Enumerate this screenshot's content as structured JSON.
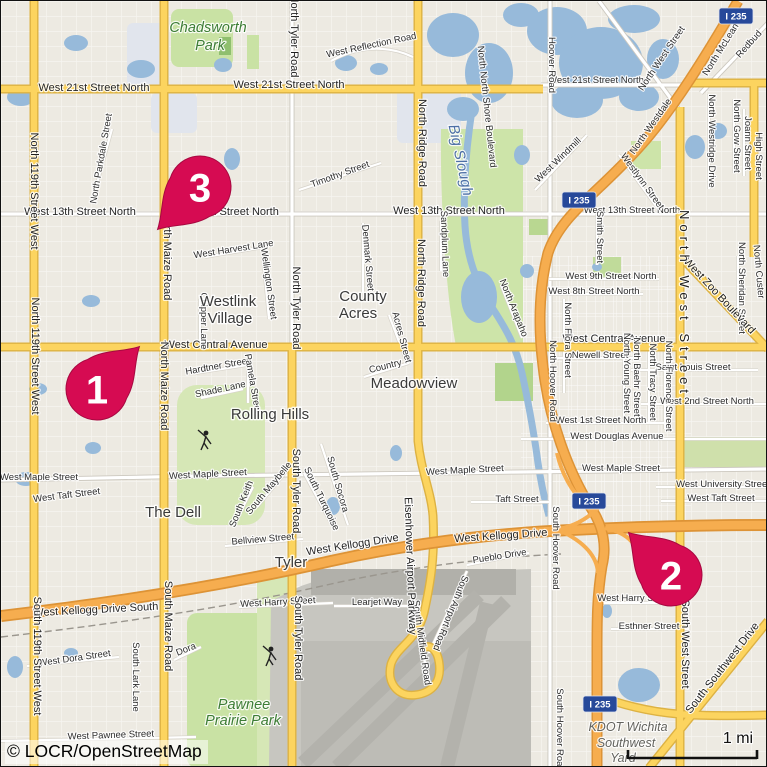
{
  "map": {
    "attribution": "© LOCR/OpenStreetMap",
    "scale_label": "1 mi",
    "colors": {
      "marker": "#d60b52",
      "marker_edge": "#a70840",
      "road_yellow": "#fcd45f",
      "road_yellow_casing": "#ddb243",
      "road_orange": "#f6ad4f",
      "road_orange_casing": "#dd9336",
      "road_white": "#ffffff",
      "road_white_casing": "#ccc8bf",
      "water": "#97bada",
      "park": "#c9e2a4",
      "golf": "#d6e7b6",
      "airport": "#c7c6c0",
      "shield_blue": "#27499a"
    },
    "markers": [
      {
        "label": "1",
        "x": 96,
        "y": 388,
        "rot": 45
      },
      {
        "label": "2",
        "x": 670,
        "y": 574,
        "rot": -45
      },
      {
        "label": "3",
        "x": 199,
        "y": 186,
        "rot": -135
      }
    ],
    "shields": [
      {
        "label": "I 235",
        "x": 735,
        "y": 15
      },
      {
        "label": "I 235",
        "x": 578,
        "y": 199
      },
      {
        "label": "I 235",
        "x": 588,
        "y": 500
      },
      {
        "label": "I 235",
        "x": 599,
        "y": 703
      }
    ],
    "labels": [
      {
        "t": "West 21st Street North",
        "x": 93,
        "y": 90,
        "c": "stl"
      },
      {
        "t": "West 21st Street North",
        "x": 288,
        "y": 87,
        "c": "stl"
      },
      {
        "t": "West 21st Street North",
        "x": 595,
        "y": 82,
        "c": "st"
      },
      {
        "t": "West 13th Street North",
        "x": 79,
        "y": 214,
        "c": "stl"
      },
      {
        "t": "West 13th Street North",
        "x": 222,
        "y": 214,
        "c": "stl"
      },
      {
        "t": "West 13th Street North",
        "x": 448,
        "y": 213,
        "c": "stl"
      },
      {
        "t": "West 13th Street North",
        "x": 631,
        "y": 212,
        "c": "st"
      },
      {
        "t": "West Central Avenue",
        "x": 215,
        "y": 347,
        "c": "stl"
      },
      {
        "t": "West Central Avenue",
        "x": 613,
        "y": 341,
        "c": "stl"
      },
      {
        "t": "West Kellogg Drive",
        "x": 352,
        "y": 547,
        "r": -9,
        "c": "stl"
      },
      {
        "t": "West Kellogg Drive",
        "x": 500,
        "y": 538,
        "r": -4,
        "c": "stl"
      },
      {
        "t": "West Kellogg Drive South",
        "x": 95,
        "y": 612,
        "r": -3,
        "c": "stl"
      },
      {
        "t": "West Reflection Road",
        "x": 371,
        "y": 47,
        "r": -12,
        "c": "st"
      },
      {
        "t": "Timothy Street",
        "x": 340,
        "y": 176,
        "r": -20,
        "c": "st"
      },
      {
        "t": "West Harvest Lane",
        "x": 233,
        "y": 251,
        "r": -9,
        "c": "st"
      },
      {
        "t": "West 9th Street North",
        "x": 610,
        "y": 278,
        "c": "st"
      },
      {
        "t": "West 8th Street North",
        "x": 593,
        "y": 293,
        "c": "st"
      },
      {
        "t": "Newell Street",
        "x": 599,
        "y": 357,
        "c": "st"
      },
      {
        "t": "Saint Louis Street",
        "x": 692,
        "y": 369,
        "c": "st"
      },
      {
        "t": "West 2nd Street North",
        "x": 706,
        "y": 403,
        "c": "st"
      },
      {
        "t": "West 1st Street North",
        "x": 600,
        "y": 422,
        "c": "st"
      },
      {
        "t": "West Douglas Avenue",
        "x": 616,
        "y": 438,
        "c": "st"
      },
      {
        "t": "West Maple Street",
        "x": 38,
        "y": 479,
        "c": "st"
      },
      {
        "t": "West Maple Street",
        "x": 207,
        "y": 476,
        "r": -3,
        "c": "st"
      },
      {
        "t": "West Maple Street",
        "x": 464,
        "y": 472,
        "r": -3,
        "c": "st"
      },
      {
        "t": "West Maple Street",
        "x": 620,
        "y": 470,
        "c": "st"
      },
      {
        "t": "West University Street",
        "x": 722,
        "y": 486,
        "c": "st"
      },
      {
        "t": "West Taft Street",
        "x": 66,
        "y": 497,
        "r": -7,
        "c": "st"
      },
      {
        "t": "Taft Street",
        "x": 516,
        "y": 501,
        "c": "st"
      },
      {
        "t": "West Taft Street",
        "x": 720,
        "y": 500,
        "c": "st"
      },
      {
        "t": "Hardtner Street",
        "x": 217,
        "y": 368,
        "r": -10,
        "c": "st"
      },
      {
        "t": "Shade Lane",
        "x": 220,
        "y": 391,
        "r": -12,
        "c": "st"
      },
      {
        "t": "Pamela Street",
        "x": 249,
        "y": 383,
        "r": 80,
        "c": "st"
      },
      {
        "t": "Chipper Lane",
        "x": 200,
        "y": 320,
        "r": 90,
        "c": "st"
      },
      {
        "t": "West Harry Street",
        "x": 277,
        "y": 604,
        "r": -3,
        "c": "st"
      },
      {
        "t": "West Harry Street",
        "x": 634,
        "y": 600,
        "c": "st"
      },
      {
        "t": "Esthner Street",
        "x": 648,
        "y": 628,
        "c": "st"
      },
      {
        "t": "Pueblo Drive",
        "x": 499,
        "y": 558,
        "r": -9,
        "c": "st"
      },
      {
        "t": "Bellview Street",
        "x": 262,
        "y": 541,
        "r": -5,
        "c": "st"
      },
      {
        "t": "Learjet Way",
        "x": 376,
        "y": 604,
        "c": "st"
      },
      {
        "t": "West Dora Street",
        "x": 74,
        "y": 660,
        "r": -8,
        "c": "st"
      },
      {
        "t": "West Pawnee Street",
        "x": 110,
        "y": 737,
        "r": -2,
        "c": "st"
      },
      {
        "t": "Dora",
        "x": 186,
        "y": 651,
        "r": -22,
        "c": "st"
      },
      {
        "t": "West Windmill",
        "x": 559,
        "y": 161,
        "r": -44,
        "c": "st"
      },
      {
        "t": "Westlynn Street",
        "x": 639,
        "y": 182,
        "r": 54,
        "c": "st"
      },
      {
        "t": "Smith Street",
        "x": 596,
        "y": 236,
        "r": 90,
        "c": "st"
      },
      {
        "t": "Denmark Street",
        "x": 364,
        "y": 257,
        "r": 85,
        "c": "st"
      },
      {
        "t": "Sandplum Lane",
        "x": 441,
        "y": 243,
        "r": 88,
        "c": "st"
      },
      {
        "t": "North North Shore Boulevard",
        "x": 483,
        "y": 106,
        "r": 84,
        "c": "st"
      },
      {
        "t": "Acres Street",
        "x": 398,
        "y": 337,
        "r": 75,
        "c": "st"
      },
      {
        "t": "Country",
        "x": 385,
        "y": 368,
        "r": -14,
        "c": "st"
      },
      {
        "t": "North Arapaho",
        "x": 510,
        "y": 308,
        "r": 68,
        "c": "st"
      },
      {
        "t": "Wellington Street",
        "x": 265,
        "y": 283,
        "r": 82,
        "c": "st"
      },
      {
        "t": "North Parkdale Street",
        "x": 103,
        "y": 158,
        "r": -80,
        "c": "st"
      },
      {
        "t": "North McLean",
        "x": 722,
        "y": 50,
        "r": -58,
        "c": "st"
      },
      {
        "t": "Redbud",
        "x": 750,
        "y": 45,
        "r": -48,
        "c": "st"
      },
      {
        "t": "North Westridge Drive",
        "x": 708,
        "y": 140,
        "r": 90,
        "c": "st"
      },
      {
        "t": "North Gow Street",
        "x": 733,
        "y": 135,
        "r": 90,
        "c": "st"
      },
      {
        "t": "Joann Street",
        "x": 744,
        "y": 142,
        "r": 90,
        "c": "st"
      },
      {
        "t": "High Street",
        "x": 755,
        "y": 155,
        "r": 90,
        "c": "st"
      },
      {
        "t": "North Sheridan Street",
        "x": 738,
        "y": 287,
        "r": 90,
        "c": "st"
      },
      {
        "t": "North Custer",
        "x": 755,
        "y": 271,
        "r": 85,
        "c": "st"
      },
      {
        "t": "North Flora Street",
        "x": 564,
        "y": 339,
        "r": 90,
        "c": "st"
      },
      {
        "t": "North Young Street",
        "x": 623,
        "y": 372,
        "r": 90,
        "c": "st"
      },
      {
        "t": "North Baehr Street",
        "x": 633,
        "y": 376,
        "r": 90,
        "c": "st"
      },
      {
        "t": "North Tracy Street",
        "x": 649,
        "y": 381,
        "r": 90,
        "c": "st"
      },
      {
        "t": "North Florence Street",
        "x": 665,
        "y": 385,
        "r": 90,
        "c": "st"
      },
      {
        "t": "South Maybelle",
        "x": 270,
        "y": 489,
        "r": -50,
        "c": "st"
      },
      {
        "t": "South Turquoise",
        "x": 318,
        "y": 499,
        "r": 64,
        "c": "st"
      },
      {
        "t": "South Socora",
        "x": 334,
        "y": 484,
        "r": 74,
        "c": "st"
      },
      {
        "t": "South Keith",
        "x": 243,
        "y": 504,
        "r": -68,
        "c": "st"
      },
      {
        "t": "South Lark Lane",
        "x": 132,
        "y": 676,
        "r": 90,
        "c": "st"
      },
      {
        "t": "South Midfield Road",
        "x": 418,
        "y": 642,
        "r": 82,
        "c": "st"
      },
      {
        "t": "South Airport Road",
        "x": 447,
        "y": 611,
        "r": 112,
        "c": "st"
      },
      {
        "t": "Hoover Road",
        "x": 548,
        "y": 64,
        "r": 90,
        "c": "st"
      },
      {
        "t": "North Hoover Road",
        "x": 549,
        "y": 380,
        "r": 90,
        "c": "st"
      },
      {
        "t": "South Hoover Road",
        "x": 552,
        "y": 547,
        "r": 90,
        "c": "st"
      },
      {
        "t": "South Hoover Road",
        "x": 556,
        "y": 729,
        "r": 90,
        "c": "st"
      },
      {
        "t": "North 119th Street West",
        "x": 30,
        "y": 190,
        "r": 90,
        "c": "rd"
      },
      {
        "t": "North 119th Street West",
        "x": 31,
        "y": 355,
        "r": 90,
        "c": "rd"
      },
      {
        "t": "South 119th Street West",
        "x": 33,
        "y": 655,
        "r": 90,
        "c": "rd"
      },
      {
        "t": "North Maize Road",
        "x": 163,
        "y": 255,
        "r": 90,
        "c": "rd"
      },
      {
        "t": "North Maize Road",
        "x": 160,
        "y": 385,
        "r": 90,
        "c": "rd"
      },
      {
        "t": "South Maize Road",
        "x": 164,
        "y": 625,
        "r": 90,
        "c": "rd"
      },
      {
        "t": "North Tyler Road",
        "x": 290,
        "y": 35,
        "r": 90,
        "c": "rd"
      },
      {
        "t": "North Tyler Road",
        "x": 292,
        "y": 307,
        "r": 90,
        "c": "rd"
      },
      {
        "t": "South Tyler Road",
        "x": 292,
        "y": 490,
        "r": 90,
        "c": "rd"
      },
      {
        "t": "South Tyler Road",
        "x": 294,
        "y": 637,
        "r": 90,
        "c": "rd"
      },
      {
        "t": "North Ridge Road",
        "x": 418,
        "y": 142,
        "r": 90,
        "c": "rd"
      },
      {
        "t": "North Ridge Road",
        "x": 417,
        "y": 282,
        "r": 90,
        "c": "rd"
      },
      {
        "t": "Eisenhower Airport Parkway",
        "x": 406,
        "y": 565,
        "r": 88,
        "c": "rd"
      },
      {
        "t": "West Zoo Boulevard",
        "x": 716,
        "y": 297,
        "r": 47,
        "c": "rd"
      },
      {
        "t": "North West Street",
        "x": 663,
        "y": 59,
        "r": -56,
        "c": "st"
      },
      {
        "t": "North West Street",
        "x": 679,
        "y": 303,
        "r": 90,
        "c": "rdl"
      },
      {
        "t": "South West Street",
        "x": 681,
        "y": 643,
        "r": 90,
        "c": "rd"
      },
      {
        "t": "South Southwest Drive",
        "x": 724,
        "y": 669,
        "r": -52,
        "c": "rd"
      },
      {
        "t": "North Westdale",
        "x": 652,
        "y": 127,
        "r": -55,
        "c": "st"
      },
      {
        "t": "Chadsworth",
        "x": 207,
        "y": 31,
        "c": "pk"
      },
      {
        "t": "Park",
        "x": 209,
        "y": 49,
        "c": "pk"
      },
      {
        "t": "Pawnee",
        "x": 243,
        "y": 708,
        "c": "pk"
      },
      {
        "t": "Prairie Park",
        "x": 242,
        "y": 724,
        "c": "pk"
      },
      {
        "t": "Big Slough",
        "x": 455,
        "y": 160,
        "r": 78,
        "c": "wt"
      },
      {
        "t": "Westlink",
        "x": 227,
        "y": 305,
        "c": "ar"
      },
      {
        "t": "Village",
        "x": 229,
        "y": 322,
        "c": "ar"
      },
      {
        "t": "County",
        "x": 362,
        "y": 300,
        "c": "ar"
      },
      {
        "t": "Acres",
        "x": 357,
        "y": 317,
        "c": "ar"
      },
      {
        "t": "Meadowview",
        "x": 413,
        "y": 387,
        "c": "ar"
      },
      {
        "t": "Rolling Hills",
        "x": 269,
        "y": 418,
        "c": "ar"
      },
      {
        "t": "The Dell",
        "x": 172,
        "y": 516,
        "c": "ar"
      },
      {
        "t": "Tyler",
        "x": 290,
        "y": 566,
        "c": "ar"
      },
      {
        "t": "KDOT Wichita",
        "x": 627,
        "y": 730,
        "c": "ind"
      },
      {
        "t": "Southwest",
        "x": 625,
        "y": 746,
        "c": "ind"
      },
      {
        "t": "Yard",
        "x": 622,
        "y": 761,
        "c": "ind"
      }
    ]
  }
}
